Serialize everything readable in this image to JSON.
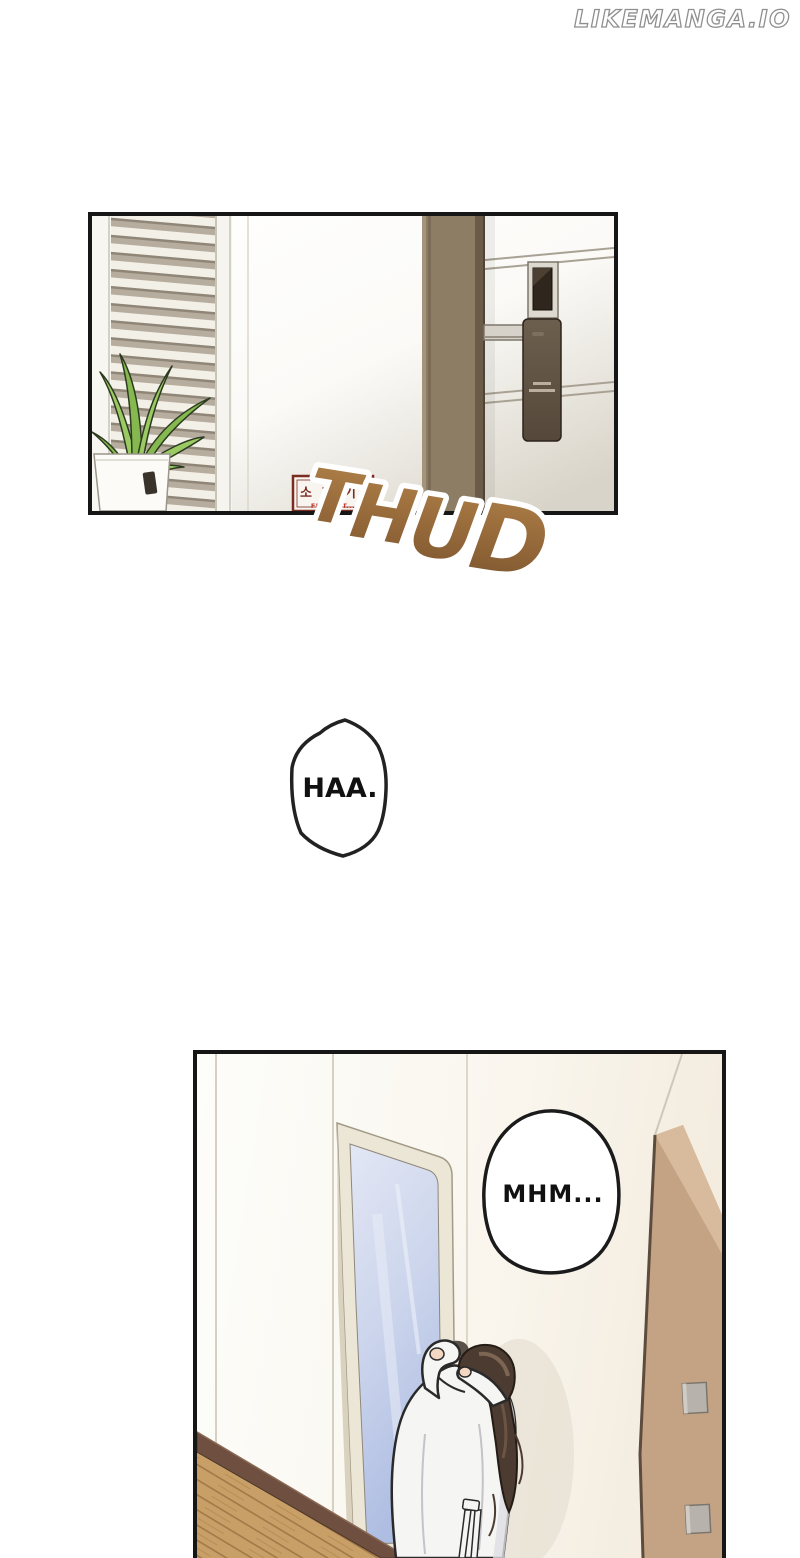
{
  "watermark": {
    "text": "LIKEMANGA.IO"
  },
  "panels": [
    {
      "name": "hallway-door-panel",
      "border_color": "#161616",
      "sign": {
        "korean_text": "소화기",
        "english_text": "FIRE EXT...",
        "border_color": "#7b2b20",
        "korean_color": "#7b2b20",
        "english_color": "#c03a2b"
      }
    },
    {
      "name": "mirror-embrace-panel",
      "border_color": "#161616"
    }
  ],
  "sfx": {
    "thud": {
      "letters": [
        "T",
        "H",
        "U",
        "D"
      ],
      "fill_top": "#b08148",
      "fill_bottom": "#7a552e",
      "outline": "#ffffff"
    }
  },
  "speech_bubbles": [
    {
      "text": "HAA.",
      "fill": "#ffffff",
      "stroke": "#222222"
    },
    {
      "text": "MHM...",
      "fill": "#ffffff",
      "stroke": "#1b1b1b"
    }
  ],
  "colors": {
    "door_frame": "#8e7d65",
    "blind_dark": "#b7ad9f",
    "blind_light": "#f3f0e8",
    "plant_green": "#9bca63",
    "mirror_glass": "#ccd5ec",
    "wood_floor": "#c99f68",
    "tan_wall": "#c4a384",
    "hair": "#4c3b30",
    "robe": "#f5f5f3"
  }
}
